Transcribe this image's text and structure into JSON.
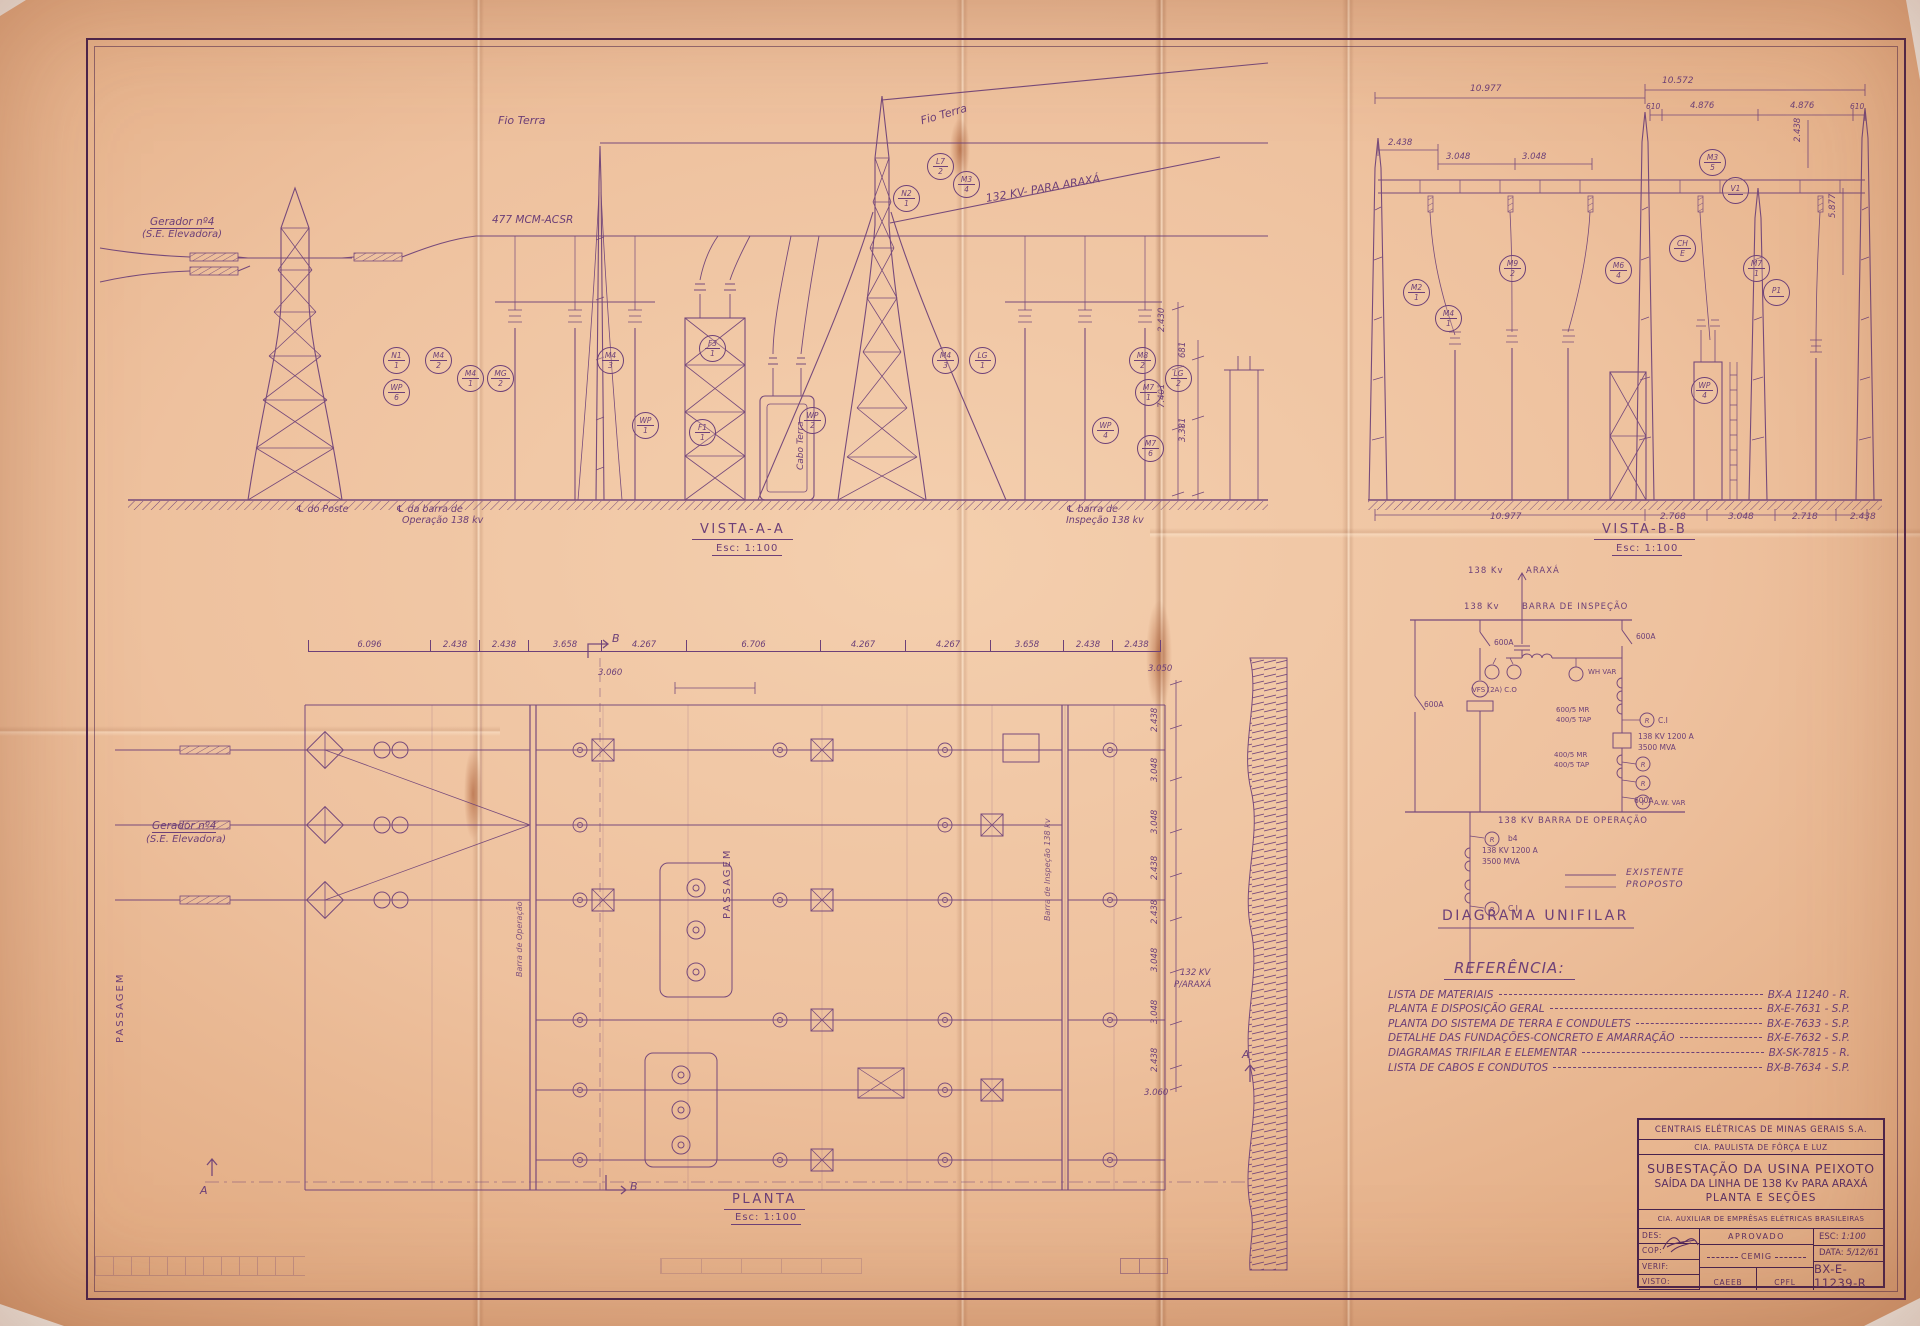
{
  "vista_aa": {
    "title": "VISTA-A-A",
    "scale": "Esc: 1:100",
    "fio_terra_h": "Fio Terra",
    "fio_terra_i": "Fio Terra",
    "conductor": "477 MCM-ACSR",
    "para_araxa": "132 KV- PARA ARAXÁ",
    "gerador_1": "Gerador nº4",
    "gerador_2": "(S.E. Elevadora)",
    "cabo_terra": "Cabo Terra",
    "gl_poste": "℄ do Poste",
    "gl_oper_1": "℄ da barra de",
    "gl_oper_2": "Operação 138 kv",
    "gl_insp_1": "℄ barra de",
    "gl_insp_2": "Inspeção 138 kv",
    "dims_right": [
      "2.430",
      "7.401",
      "681",
      "3.381"
    ],
    "balloons": [
      {
        "t": "M4",
        "b": "1"
      },
      {
        "t": "MG",
        "b": "2"
      },
      {
        "t": "M4",
        "b": "2"
      },
      {
        "t": "N1",
        "b": "1"
      },
      {
        "t": "WP",
        "b": "6"
      },
      {
        "t": "F3",
        "b": "1"
      },
      {
        "t": "M4",
        "b": "3"
      },
      {
        "t": "WP",
        "b": "1"
      },
      {
        "t": "F1",
        "b": "1"
      },
      {
        "t": "WP",
        "b": "2"
      },
      {
        "t": "M4",
        "b": "3"
      },
      {
        "t": "LG",
        "b": "1"
      },
      {
        "t": "L7",
        "b": "2"
      },
      {
        "t": "M3",
        "b": "4"
      },
      {
        "t": "N2",
        "b": "1"
      },
      {
        "t": "M8",
        "b": "2"
      },
      {
        "t": "M7",
        "b": "1"
      },
      {
        "t": "WP",
        "b": "4"
      },
      {
        "t": "LG",
        "b": "2"
      },
      {
        "t": "M7",
        "b": "6"
      }
    ]
  },
  "vista_bb": {
    "title": "VISTA-B-B",
    "scale": "Esc: 1:100",
    "dim_top_left": "10.977",
    "dim_top_right": "10.572",
    "dim_2438": "2.438",
    "dims_3048": [
      "3.048",
      "3.048"
    ],
    "dims_476": [
      "610",
      "4.876",
      "4.876",
      "610"
    ],
    "dims_right": [
      "2.438",
      "5.877"
    ],
    "dims_bottom": [
      "10.977",
      "2.768",
      "3.048",
      "2.718",
      "2.438"
    ],
    "balloons": [
      {
        "t": "M3",
        "b": "5"
      },
      {
        "t": "V1",
        "b": ""
      },
      {
        "t": "M6",
        "b": "4"
      },
      {
        "t": "M9",
        "b": "2"
      },
      {
        "t": "CH",
        "b": "E"
      },
      {
        "t": "M7",
        "b": "1"
      },
      {
        "t": "P1",
        "b": ""
      },
      {
        "t": "WP",
        "b": "4"
      },
      {
        "t": "M2",
        "b": "1"
      },
      {
        "t": "M4",
        "b": "1"
      }
    ]
  },
  "planta": {
    "title": "PLANTA",
    "scale": "Esc: 1:100",
    "dims_top": [
      "6.096",
      "2.438",
      "2.438",
      "3.658",
      "4.267",
      "6.706",
      "4.267",
      "4.267",
      "3.658",
      "2.438",
      "2.438"
    ],
    "dim_3060": "3.060",
    "dims_right_top": "3.050",
    "dims_right": [
      "2.438",
      "3.048",
      "3.048",
      "2.438",
      "2.438",
      "3.048",
      "3.048",
      "2.438"
    ],
    "dims_right_bottom": "3.060",
    "passagem_left": "PASSAGEM",
    "passagem_mid": "PASSAGEM",
    "gerador_1": "Gerador nº4",
    "gerador_2": "(S.E. Elevadora)",
    "barra_operacao": "Barra de Operação",
    "barra_inspecao": "Barra de Inspeção 138 kv",
    "kv_araxa_1": "132 KV",
    "kv_araxa_2": "P/ARAXÁ",
    "sec_a": "A",
    "sec_b": "B"
  },
  "unifilar": {
    "title": "DIAGRAMA UNIFILAR",
    "kv_araxa": "138 Kv",
    "araxa": "ARAXÁ",
    "kv_insp": "138 Kv",
    "barra_inspecao": "BARRA DE INSPEÇÃO",
    "barra_operacao": "138 KV  BARRA DE OPERAÇÃO",
    "sw": [
      "600A",
      "600A",
      "600A",
      "600A"
    ],
    "vfs": "VFS (2A) C.O",
    "wh_var": "WH VAR",
    "ct1_1": "600/5 MR",
    "ct1_2": "400/5 TAP",
    "brk1_1": "138 KV  1200 A",
    "brk1_2": "3500 MVA",
    "ct2_1": "400/5 MR",
    "ct2_2": "400/5 TAP",
    "rel_ci_1": "C.I",
    "rel_b4": "b4",
    "rel_ci_2": "C.I",
    "aw_var": "A.W. VAR",
    "brk2_1": "138 KV  1200 A",
    "brk2_2": "3500 MVA",
    "legend_existente": "EXISTENTE",
    "legend_proposto": "PROPOSTO",
    "relays": [
      "R",
      "R",
      "R",
      "I",
      "R",
      "R"
    ]
  },
  "referencia": {
    "title": "REFERÊNCIA:",
    "items": [
      {
        "desc": "LISTA DE MATERIAIS",
        "code": "BX-A 11240 - R."
      },
      {
        "desc": "PLANTA E DISPOSIÇÃO GERAL",
        "code": "BX-E-7631 - S.P."
      },
      {
        "desc": "PLANTA DO SISTEMA DE TERRA E CONDULETS",
        "code": "BX-E-7633 - S.P."
      },
      {
        "desc": "DETALHE DAS FUNDAÇÕES-CONCRETO E AMARRAÇÃO",
        "code": "BX-E-7632 - S.P."
      },
      {
        "desc": "DIAGRAMAS TRIFILAR E ELEMENTAR",
        "code": "BX-SK-7815 - R."
      },
      {
        "desc": "LISTA DE CABOS E CONDUTOS",
        "code": "BX-B-7634 - S.P."
      }
    ]
  },
  "title_block": {
    "company1": "CENTRAIS ELÉTRICAS DE MINAS GERAIS S.A.",
    "company2": "CIA. PAULISTA DE FÔRÇA E LUZ",
    "title1": "SUBESTAÇÃO DA USINA PEIXOTO",
    "title2": "SAÍDA DA LINHA DE 138 Kv PARA ARAXÁ",
    "title3": "PLANTA E SEÇÕES",
    "company3": "CIA. AUXILIAR DE EMPRÊSAS ELÉTRICAS BRASILEIRAS",
    "des": "DES:",
    "cop": "COP:",
    "verif": "VERIF:",
    "visto": "VISTO:",
    "aprovado": "APROVADO",
    "cemig": "CEMIG",
    "caeeb": "CAEEB",
    "cpfl": "CPFL",
    "esc_label": "ESC:",
    "esc_value": "1:100",
    "data_label": "DATA:",
    "data_value": "5/12/61",
    "number": "BX-E-11239-R"
  },
  "colors": {
    "paper": "#eec19e",
    "ink": "#6d4078",
    "frame": "#47224e"
  }
}
